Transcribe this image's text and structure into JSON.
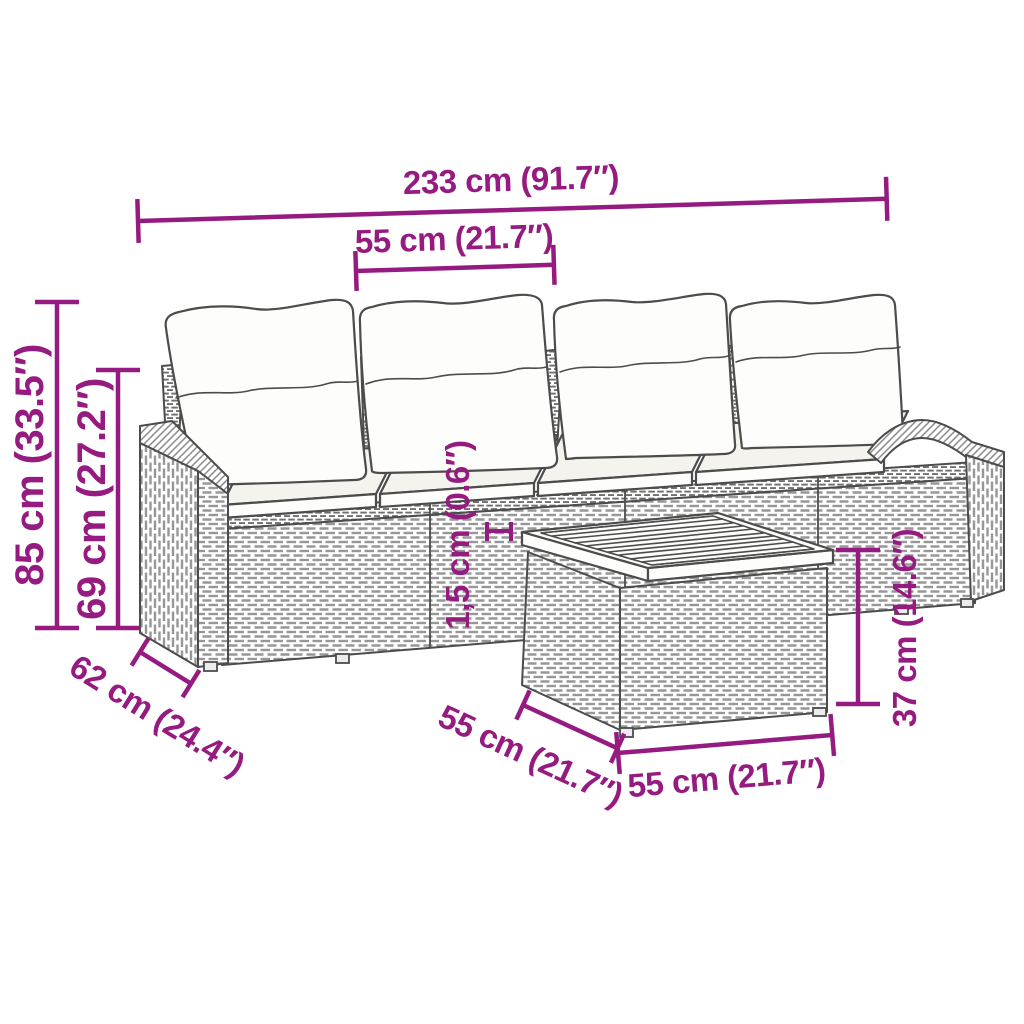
{
  "dims": {
    "overall_width": "233 cm (91.7″)",
    "seat_width": "55 cm (21.7″)",
    "overall_height": "85 cm (33.5″)",
    "back_height": "69 cm (27.2″)",
    "slat_thickness": "1,5 cm (0.6″)",
    "depth": "62 cm (24.4″)",
    "table_depth": "55 cm (21.7″)",
    "table_width": "55 cm (21.7″)",
    "table_height": "37 cm (14.6″)"
  },
  "colors": {
    "dimension_accent": "#951b81",
    "line_art": "#4c4c4c",
    "wicker": "#979797",
    "cushion": "#fdfdfb",
    "background": "#ffffff"
  }
}
